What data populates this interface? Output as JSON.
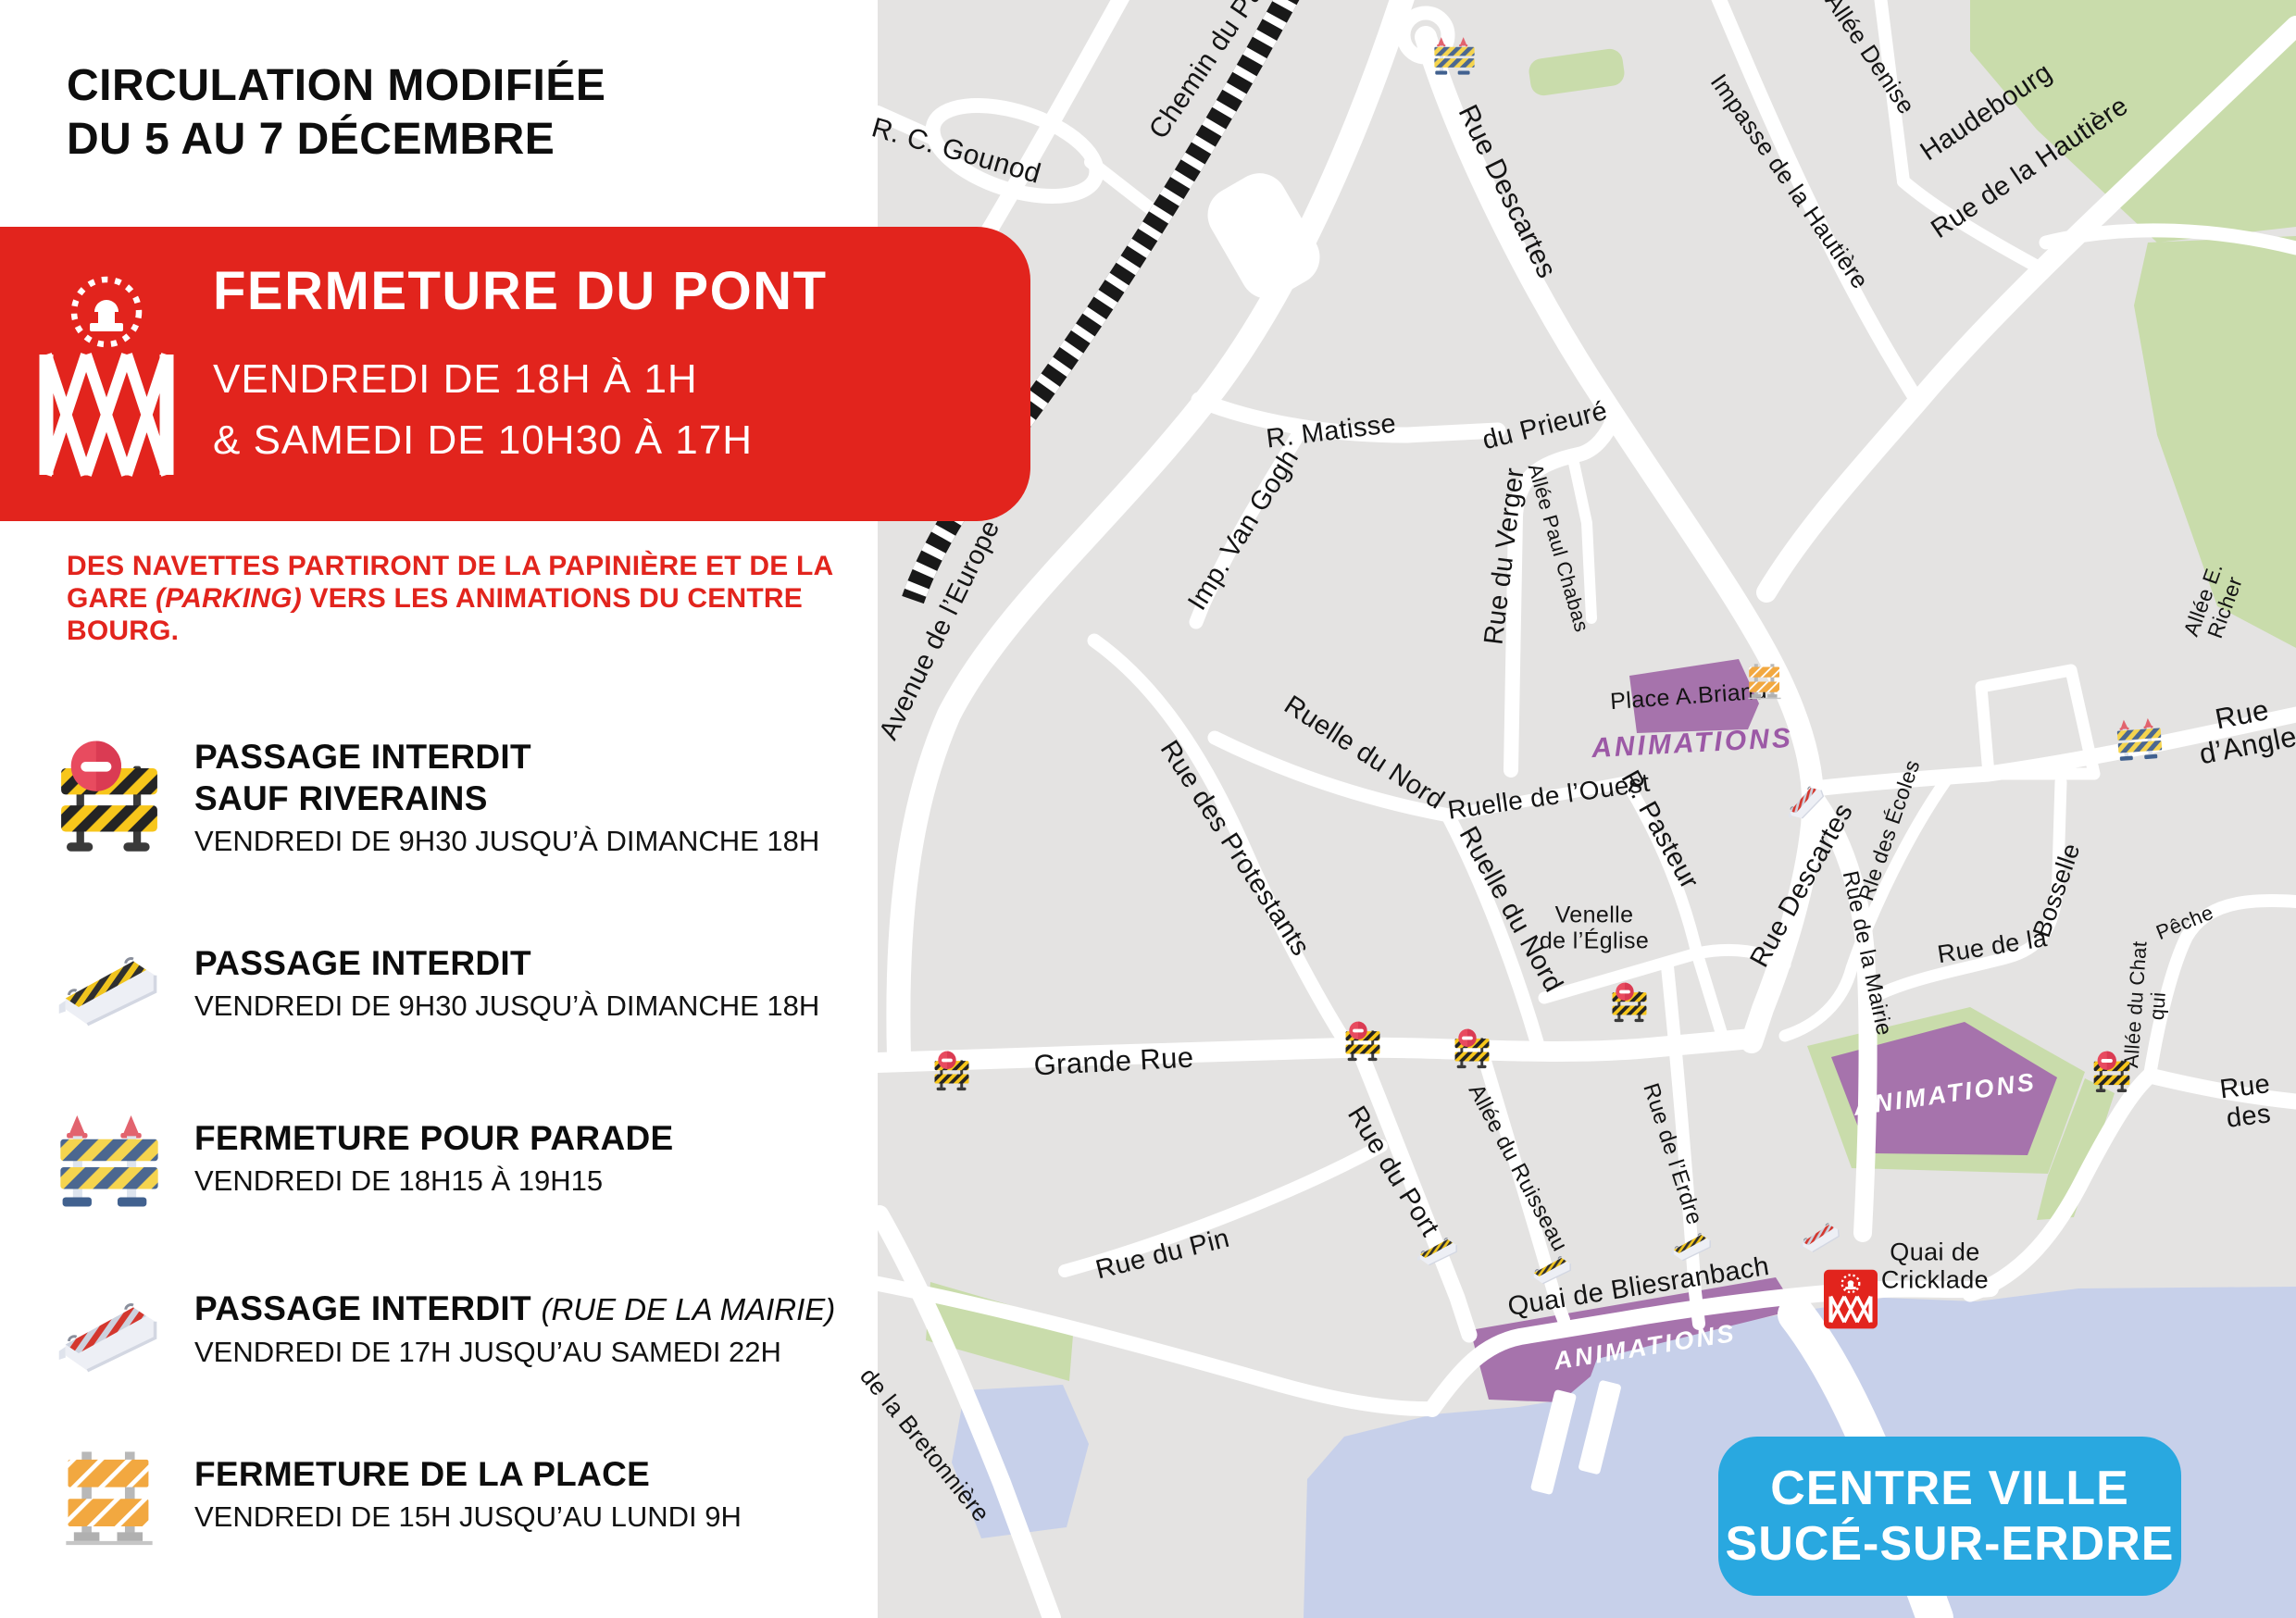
{
  "header": {
    "title_line1": "CIRCULATION MODIFIÉE",
    "title_line2": "DU 5 AU 7 DÉCEMBRE"
  },
  "banner": {
    "title": "FERMETURE DU PONT",
    "line1": "VENDREDI DE 18H À 1H",
    "line2": "& SAMEDI DE 10H30 À 17H",
    "icon": "bridge-icon"
  },
  "shuttle_note": {
    "line1": "DES NAVETTES PARTIRONT DE LA PAPINIÈRE ET DE LA",
    "line2_pre": "GARE ",
    "line2_italic": "(PARKING)",
    "line2_post": " VERS LES ANIMATIONS DU CENTRE BOURG."
  },
  "legend": {
    "items": [
      {
        "icon": "riverains",
        "title": "PASSAGE INTERDIT",
        "title2": "SAUF RIVERAINS",
        "sub": "VENDREDI DE 9H30 JUSQU’À DIMANCHE 18H"
      },
      {
        "icon": "jersey_yellow",
        "title": "PASSAGE INTERDIT",
        "sub": "VENDREDI DE 9H30 JUSQU’À DIMANCHE 18H"
      },
      {
        "icon": "parade",
        "title": "FERMETURE POUR PARADE",
        "sub": "VENDREDI DE 18H15 À 19H15"
      },
      {
        "icon": "jersey_red",
        "title": "PASSAGE INTERDIT",
        "title_paren": "(RUE DE LA MAIRIE)",
        "sub": "VENDREDI DE 17H JUSQU’AU SAMEDI 22H"
      },
      {
        "icon": "orange",
        "title": "FERMETURE DE LA PLACE",
        "sub": "VENDREDI DE 15H JUSQU’AU LUNDI 9H"
      }
    ]
  },
  "map": {
    "badge": {
      "line1": "CENTRE VILLE",
      "line2": "SUCÉ-SUR-ERDRE"
    },
    "colors": {
      "red": "#e2241d",
      "map_bg": "#e4e3e2",
      "green": "#c9dcab",
      "water": "#c7d0ea",
      "purple_zone": "#a673ac",
      "purple_text": "#9c59a6",
      "badge_blue": "#29a8e0"
    },
    "streets": [
      {
        "id": "chemin",
        "text": "Chemin du Pa"
      },
      {
        "id": "gounod",
        "text": "R. C. Gounod"
      },
      {
        "id": "descartes_n",
        "text": "Rue Descartes"
      },
      {
        "id": "imp_hautiere",
        "text": "Impasse de la Hautière"
      },
      {
        "id": "denise",
        "text": "Allée Denise"
      },
      {
        "id": "haudebourg",
        "text": "Haudebourg"
      },
      {
        "id": "hautiere",
        "text": "Rue de la Hautière"
      },
      {
        "id": "matisse",
        "text": "R. Matisse"
      },
      {
        "id": "vangogh",
        "text": "Imp. Van Gogh"
      },
      {
        "id": "prieure",
        "text": "du Prieuré"
      },
      {
        "id": "verger",
        "text": "Rue du Verger"
      },
      {
        "id": "chabas",
        "text": "Allée Paul Chabas"
      },
      {
        "id": "europe",
        "text": "Avenue de l’Europe"
      },
      {
        "id": "protestants",
        "text": "Rue des Protestants"
      },
      {
        "id": "nord_a",
        "text": "Ruelle du Nord"
      },
      {
        "id": "ouest",
        "text": "Ruelle de l’Ouest"
      },
      {
        "id": "nord_b",
        "text": "Ruelle du Nord"
      },
      {
        "id": "pasteur",
        "text": "R. Pasteur"
      },
      {
        "id": "venelle",
        "text": "Venelle\nde l’Église"
      },
      {
        "id": "descartes_s",
        "text": "Rue Descartes"
      },
      {
        "id": "ecoles",
        "text": "Rle des Écoles"
      },
      {
        "id": "bosselle_a",
        "text": "Rue de la"
      },
      {
        "id": "bosselle_b",
        "text": "Bosselle"
      },
      {
        "id": "chat",
        "text": "Allée du Chat qui"
      },
      {
        "id": "peche",
        "text": "Pêche"
      },
      {
        "id": "richer",
        "text": "Allée E. Richer"
      },
      {
        "id": "angle",
        "text": "Rue d’Angle"
      },
      {
        "id": "grande",
        "text": "Grande Rue"
      },
      {
        "id": "pin",
        "text": "Rue du Pin"
      },
      {
        "id": "port",
        "text": "Rue du Port"
      },
      {
        "id": "ruisseau",
        "text": "Allée du Ruisseau"
      },
      {
        "id": "erdre",
        "text": "Rue de l’Erdre"
      },
      {
        "id": "mairie",
        "text": "Rue de la Mairie"
      },
      {
        "id": "bliesranbach",
        "text": "Quai de Bliesranbach"
      },
      {
        "id": "cricklade",
        "text": "Quai de\nCricklade"
      },
      {
        "id": "rue_des",
        "text": "Rue des"
      },
      {
        "id": "bretonniere",
        "text": "de la Bretonnière"
      },
      {
        "id": "place_briand",
        "text": "Place A.Briand"
      },
      {
        "id": "anim1",
        "text": "ANIMATIONS"
      },
      {
        "id": "anim2",
        "text": "ANIMATIONS"
      },
      {
        "id": "anim3",
        "text": "ANIMATIONS"
      }
    ],
    "markers": [
      {
        "id": "p1",
        "type": "parade"
      },
      {
        "id": "p2",
        "type": "parade"
      },
      {
        "id": "o1",
        "type": "orange"
      },
      {
        "id": "a1",
        "type": "riverains"
      },
      {
        "id": "a2",
        "type": "riverains"
      },
      {
        "id": "a3",
        "type": "riverains"
      },
      {
        "id": "a4",
        "type": "riverains"
      },
      {
        "id": "a5",
        "type": "riverains"
      },
      {
        "id": "j1",
        "type": "jersey_yellow"
      },
      {
        "id": "j2",
        "type": "jersey_yellow"
      },
      {
        "id": "j3",
        "type": "jersey_yellow"
      },
      {
        "id": "m1",
        "type": "jersey_red"
      },
      {
        "id": "m2",
        "type": "jersey_red"
      },
      {
        "id": "br",
        "type": "bridge"
      }
    ]
  }
}
